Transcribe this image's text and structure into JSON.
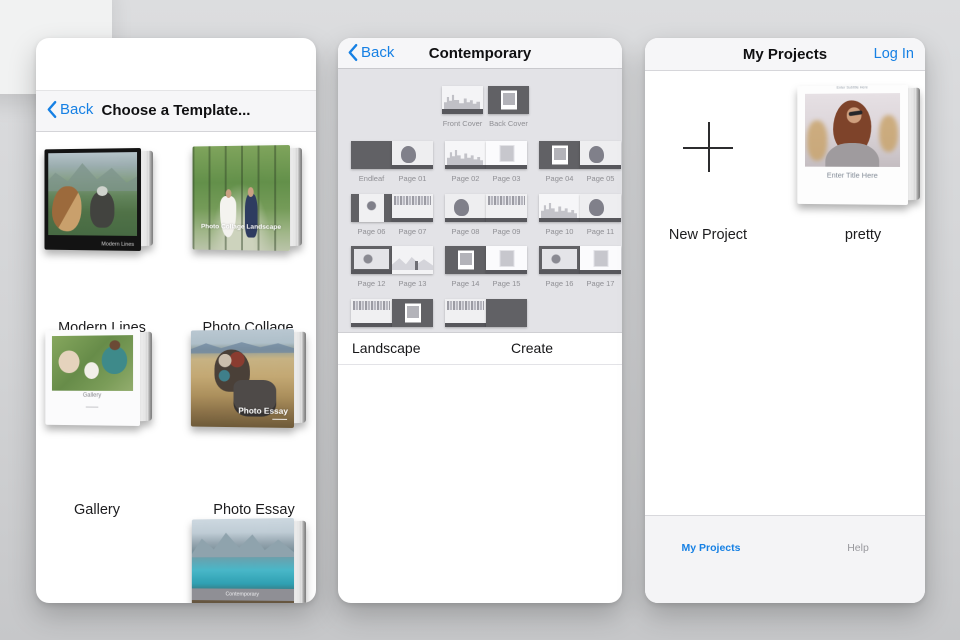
{
  "colors": {
    "accent_blue": "#1680e4",
    "sheet_bg": "#e3e3e7",
    "thumb_dark": "#616165"
  },
  "templates": {
    "back_label": "Back",
    "title": "Choose a Template...",
    "items": [
      {
        "name": "Modern Lines",
        "caption": "Modern Lines"
      },
      {
        "name": "Photo Collage",
        "caption": "Photo Collage Landscape"
      },
      {
        "name": "Gallery",
        "caption": "Gallery"
      },
      {
        "name": "Photo Essay",
        "caption": "Photo Essay"
      },
      {
        "name": "",
        "caption": "Contemporary"
      }
    ]
  },
  "contemporary": {
    "back_label": "Back",
    "title": "Contemporary",
    "covers": [
      {
        "label": "Front Cover",
        "variant": "cover-front"
      },
      {
        "label": "Back Cover",
        "variant": "dark-framed"
      }
    ],
    "spreads": [
      {
        "pages": [
          {
            "label": "Endleaf",
            "variant": "solid-dark"
          },
          {
            "label": "Page 01",
            "variant": "photo-light"
          }
        ]
      },
      {
        "pages": [
          {
            "label": "Page 02",
            "variant": "city"
          },
          {
            "label": "Page 03",
            "variant": "small-photo"
          }
        ]
      },
      {
        "pages": [
          {
            "label": "Page 04",
            "variant": "dark-framed"
          },
          {
            "label": "Page 05",
            "variant": "photo-light"
          }
        ]
      },
      {
        "pages": [
          {
            "label": "Page 06",
            "variant": "framed-light"
          },
          {
            "label": "Page 07",
            "variant": "collage"
          }
        ]
      },
      {
        "pages": [
          {
            "label": "Page 08",
            "variant": "photo-light"
          },
          {
            "label": "Page 09",
            "variant": "collage"
          }
        ]
      },
      {
        "pages": [
          {
            "label": "Page 10",
            "variant": "city"
          },
          {
            "label": "Page 11",
            "variant": "photo-light"
          }
        ]
      },
      {
        "pages": [
          {
            "label": "Page 12",
            "variant": "photo-dark"
          },
          {
            "label": "Page 13",
            "variant": "landscape"
          }
        ]
      },
      {
        "pages": [
          {
            "label": "Page 14",
            "variant": "dark-framed"
          },
          {
            "label": "Page 15",
            "variant": "small-photo"
          }
        ]
      },
      {
        "pages": [
          {
            "label": "Page 16",
            "variant": "photo-dark"
          },
          {
            "label": "Page 17",
            "variant": "small-photo"
          }
        ]
      },
      {
        "pages": [
          {
            "label": "",
            "variant": "collage"
          },
          {
            "label": "",
            "variant": "dark-framed"
          }
        ]
      },
      {
        "pages": [
          {
            "label": "",
            "variant": "collage"
          },
          {
            "label": "",
            "variant": "solid-dark"
          }
        ]
      }
    ],
    "landscape_label": "Landscape",
    "create_label": "Create"
  },
  "projects": {
    "title": "My Projects",
    "login_label": "Log In",
    "new_project_label": "New Project",
    "project": {
      "name": "pretty",
      "cover_title": "Enter Title Here",
      "cover_subtitle": "Enter Subtitle Here"
    },
    "tabs": [
      {
        "label": "My Projects",
        "active": true
      },
      {
        "label": "Help",
        "active": false
      }
    ]
  }
}
